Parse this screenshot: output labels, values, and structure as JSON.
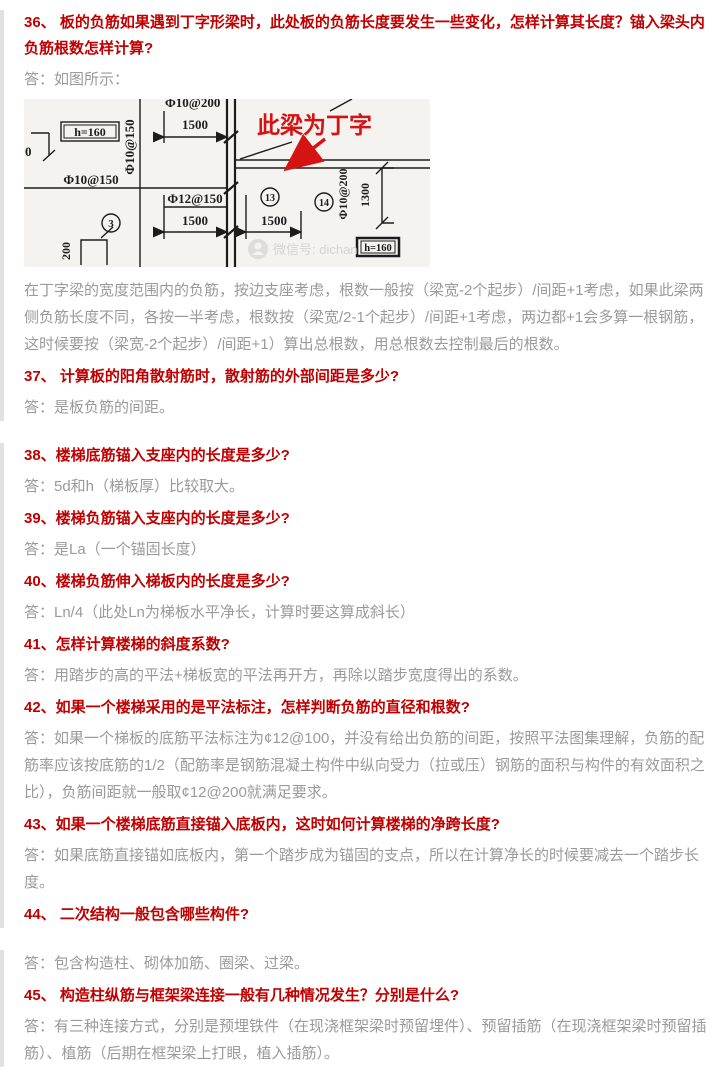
{
  "theme": {
    "question_color": "#c00000",
    "answer_color": "#9a9a9a",
    "section_border_color": "#e1e1e1",
    "diagram_bg": "#f4f3f0",
    "annotation_red": "#d61313"
  },
  "sections": [
    {
      "items": [
        {
          "kind": "question",
          "text": "36、 板的负筋如果遇到丁字形梁时，此处板的负筋长度要发生一些变化，怎样计算其长度？锚入梁头内负筋根数怎样计算?"
        },
        {
          "kind": "answer",
          "text": "答：如图所示："
        },
        {
          "kind": "diagram"
        },
        {
          "kind": "answer",
          "text": "在丁字梁的宽度范围内的负筋，按边支座考虑，根数一般按（梁宽-2个起步）/间距+1考虑，如果此梁两侧负筋长度不同，各按一半考虑，根数按（梁宽/2-1个起步）/间距+1考虑，两边都+1会多算一根钢筋，这时候要按（梁宽-2个起步）/间距+1）算出总根数，用总根数去控制最后的根数。"
        },
        {
          "kind": "question",
          "text": "37、 计算板的阳角散射筋时，散射筋的外部间距是多少?"
        },
        {
          "kind": "answer",
          "text": "答：是板负筋的间距。"
        }
      ]
    },
    {
      "items": [
        {
          "kind": "question",
          "text": "38、楼梯底筋锚入支座内的长度是多少?"
        },
        {
          "kind": "answer",
          "text": "答：5d和h（梯板厚）比较取大。"
        },
        {
          "kind": "question",
          "text": "39、楼梯负筋锚入支座内的长度是多少?"
        },
        {
          "kind": "answer",
          "text": "答：是La（一个锚固长度）"
        },
        {
          "kind": "question",
          "text": "40、楼梯负筋伸入梯板内的长度是多少?"
        },
        {
          "kind": "answer",
          "text": "答：Ln/4（此处Ln为梯板水平净长，计算时要这算成斜长）"
        },
        {
          "kind": "question",
          "text": "41、怎样计算楼梯的斜度系数?"
        },
        {
          "kind": "answer",
          "text": "答：用踏步的高的平法+梯板宽的平法再开方，再除以踏步宽度得出的系数。"
        },
        {
          "kind": "question",
          "text": "42、如果一个楼梯采用的是平法标注，怎样判断负筋的直径和根数?"
        },
        {
          "kind": "answer",
          "text": "答：如果一个梯板的底筋平法标注为¢12@100，并没有给出负筋的间距，按照平法图集理解，负筋的配筋率应该按底筋的1/2（配筋率是钢筋混凝土构件中纵向受力（拉或压）钢筋的面积与构件的有效面积之比），负筋间距就一般取¢12@200就满足要求。"
        },
        {
          "kind": "question",
          "text": "43、如果一个楼梯底筋直接锚入底板内，这时如何计算楼梯的净跨长度?"
        },
        {
          "kind": "answer",
          "text": "答：如果底筋直接锚如底板内，第一个踏步成为锚固的支点，所以在计算净长的时候要减去一个踏步长度。"
        },
        {
          "kind": "question",
          "text": "44、 二次结构一般包含哪些构件?"
        }
      ]
    },
    {
      "items": [
        {
          "kind": "answer",
          "text": "答：包含构造柱、砌体加筋、圈梁、过梁。"
        },
        {
          "kind": "question",
          "text": "45、 构造柱纵筋与框架梁连接一般有几种情况发生？分别是什么?"
        },
        {
          "kind": "answer",
          "text": "答：有三种连接方式，分别是预埋铁件（在现浇框架梁时预留埋件）、预留插筋（在现浇框架梁时预留插筋）、植筋（后期在框架梁上打眼，植入插筋）。"
        }
      ]
    }
  ],
  "diagram": {
    "annotation": "此梁为丁字",
    "watermark": "微信号: dichan",
    "labels": {
      "top_spacing": "Φ10@200",
      "top_dim": "1500",
      "slab_thickness_left": "h=160",
      "left_vertical_spacing": "Φ10@150",
      "left_horizontal_spacing": "Φ10@150",
      "left_cut_dim": "0",
      "mid_spacing": "Φ12@150",
      "bottom_left_dim": "1500",
      "bottom_right_dim": "1500",
      "right_spacing": "Φ10@200",
      "right_dim": "1300",
      "dim_200": "200",
      "slab_thickness_right": "h=160",
      "panel_3": "3",
      "panel_13": "13",
      "panel_14": "14"
    }
  }
}
